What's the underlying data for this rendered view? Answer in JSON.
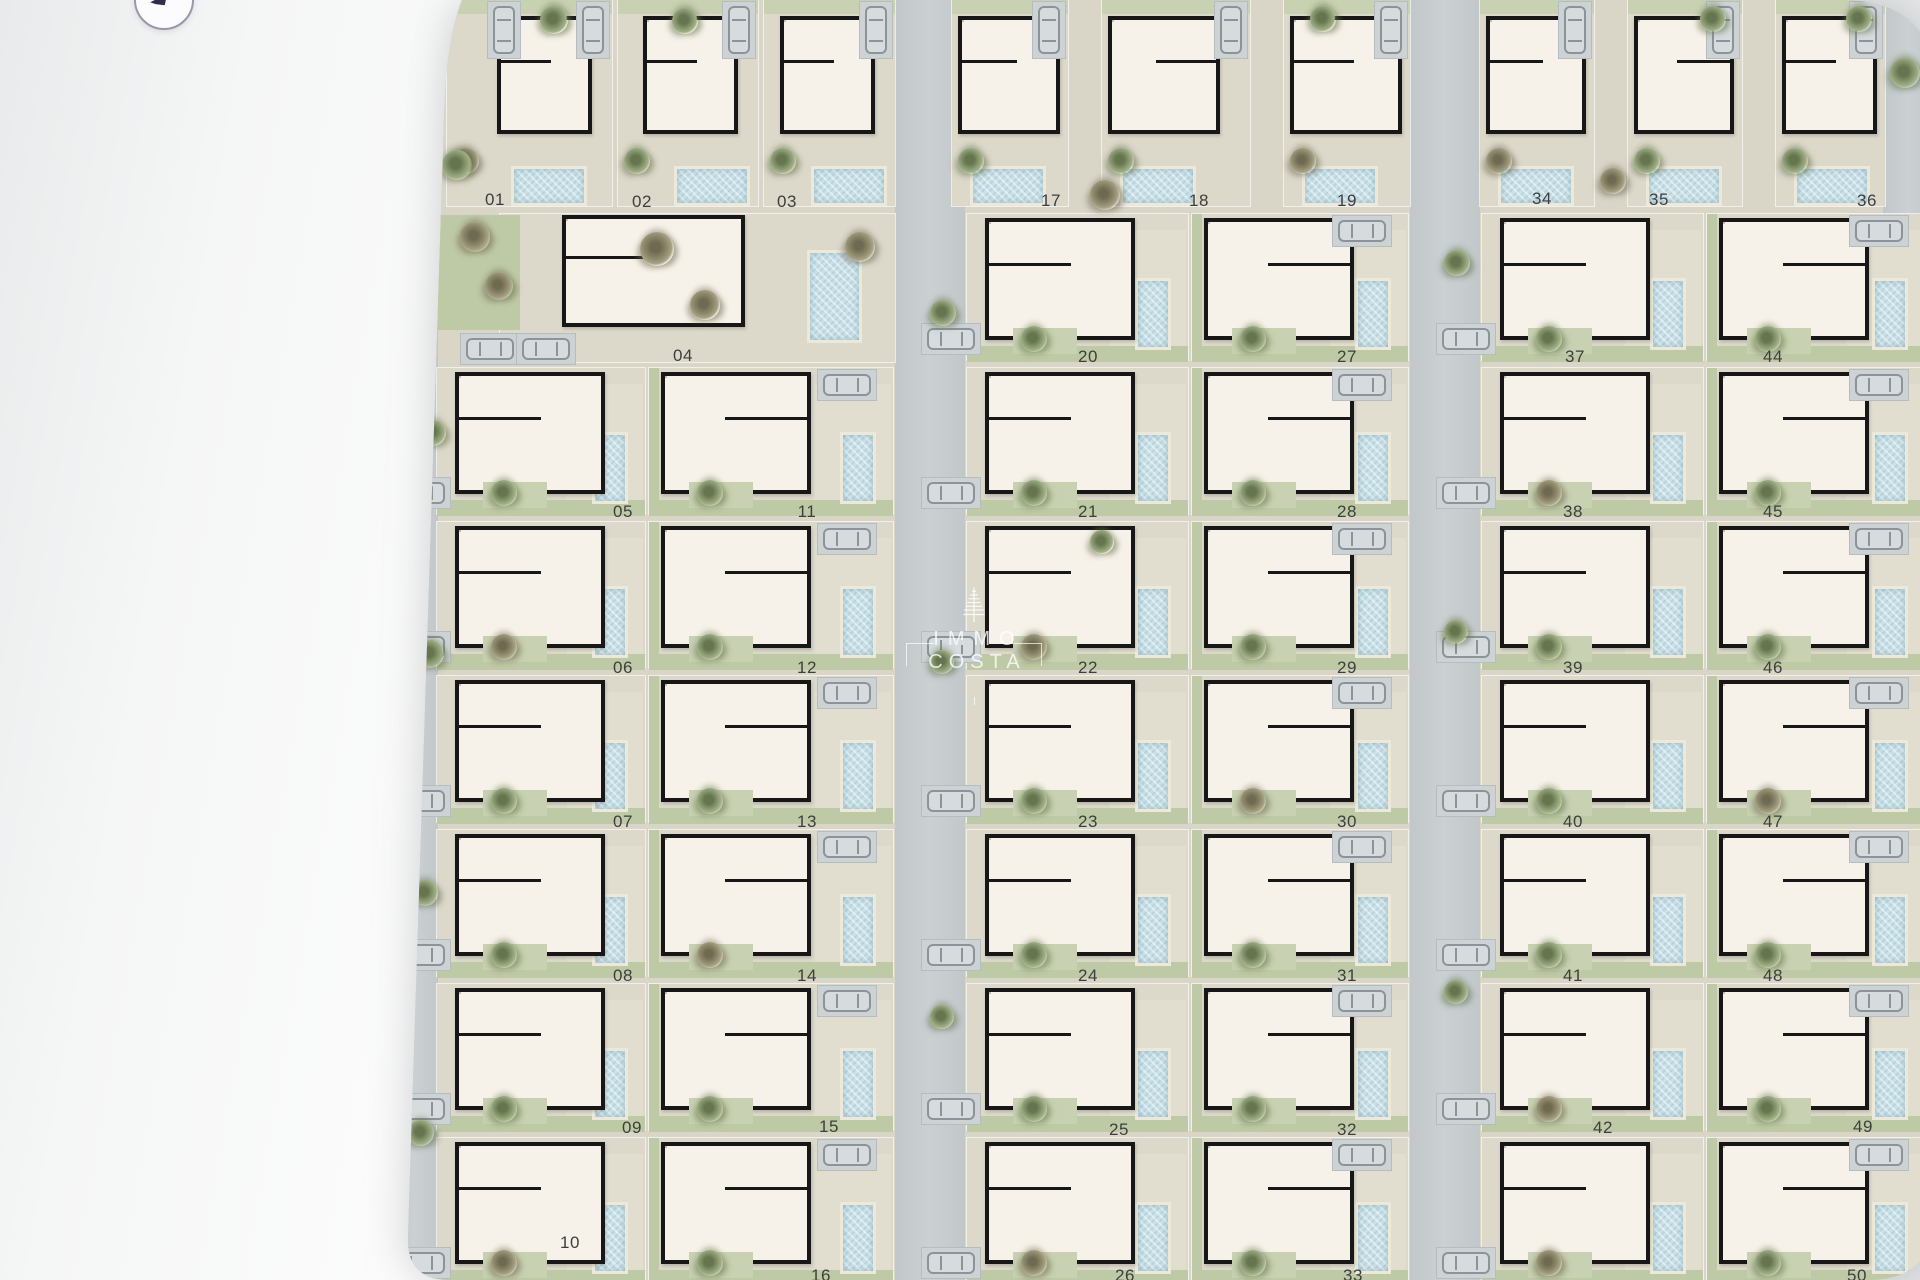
{
  "controls": {
    "back_button_icon": "back-arrow"
  },
  "watermark": {
    "line1": "IMMO",
    "line2": "COSTA",
    "icon": "cypress-tree"
  },
  "site_plan": {
    "type": "residential-site-plan",
    "description_labels_visible": [
      "01",
      "02",
      "03",
      "04",
      "05",
      "06",
      "07",
      "08",
      "09",
      "10",
      "11",
      "12",
      "13",
      "14",
      "15",
      "16",
      "17",
      "18",
      "19",
      "20",
      "21",
      "22",
      "23",
      "24",
      "25",
      "26",
      "27",
      "28",
      "29",
      "30",
      "31",
      "32",
      "33",
      "34",
      "35",
      "36",
      "37",
      "38",
      "39",
      "40",
      "41",
      "42",
      "44",
      "45",
      "46",
      "47",
      "48",
      "49",
      "50"
    ],
    "colors": {
      "road": "#c7cccd",
      "lot_paving": "#dcd8ca",
      "garden": "#bec9a5",
      "house_floor": "#f7f2e9",
      "wall": "#171717",
      "pool_water": "#cbe1e7",
      "pool_deck": "#ece8da",
      "label": "#3e3e3e",
      "page_background": "#ededee",
      "watermark": "#ffffff"
    },
    "plots": [
      {
        "number": "01",
        "block": 0,
        "row": "T",
        "col": 0,
        "label_x": 300,
        "label_y": 200
      },
      {
        "number": "02",
        "block": 0,
        "row": "T",
        "col": 1,
        "label_x": 447,
        "label_y": 202
      },
      {
        "number": "03",
        "block": 0,
        "row": "T",
        "col": 2,
        "label_x": 592,
        "label_y": 202
      },
      {
        "number": "04",
        "block": 0,
        "row": 0,
        "col": "W",
        "label_x": 488,
        "label_y": 356
      },
      {
        "number": "05",
        "block": 0,
        "row": 1,
        "col": 0,
        "label_x": 428,
        "label_y": 512
      },
      {
        "number": "06",
        "block": 0,
        "row": 2,
        "col": 0,
        "label_x": 428,
        "label_y": 668
      },
      {
        "number": "07",
        "block": 0,
        "row": 3,
        "col": 0,
        "label_x": 428,
        "label_y": 822
      },
      {
        "number": "08",
        "block": 0,
        "row": 4,
        "col": 0,
        "label_x": 428,
        "label_y": 976
      },
      {
        "number": "09",
        "block": 0,
        "row": 5,
        "col": 0,
        "label_x": 437,
        "label_y": 1128
      },
      {
        "number": "10",
        "block": 0,
        "row": 6,
        "col": 0,
        "label_x": 375,
        "label_y": 1243
      },
      {
        "number": "11",
        "block": 0,
        "row": 1,
        "col": 1,
        "label_x": 612,
        "label_y": 512
      },
      {
        "number": "12",
        "block": 0,
        "row": 2,
        "col": 1,
        "label_x": 612,
        "label_y": 668
      },
      {
        "number": "13",
        "block": 0,
        "row": 3,
        "col": 1,
        "label_x": 612,
        "label_y": 822
      },
      {
        "number": "14",
        "block": 0,
        "row": 4,
        "col": 1,
        "label_x": 612,
        "label_y": 976
      },
      {
        "number": "15",
        "block": 0,
        "row": 5,
        "col": 1,
        "label_x": 634,
        "label_y": 1127
      },
      {
        "number": "16",
        "block": 0,
        "row": 6,
        "col": 1,
        "label_x": 626,
        "label_y": 1276,
        "partial": true
      },
      {
        "number": "17",
        "block": 1,
        "row": "T",
        "col": 0,
        "label_x": 856,
        "label_y": 201
      },
      {
        "number": "18",
        "block": 1,
        "row": "T",
        "col": 1,
        "label_x": 1004,
        "label_y": 201
      },
      {
        "number": "19",
        "block": 1,
        "row": "T",
        "col": 2,
        "label_x": 1152,
        "label_y": 201
      },
      {
        "number": "20",
        "block": 1,
        "row": 0,
        "col": 0,
        "label_x": 893,
        "label_y": 357
      },
      {
        "number": "21",
        "block": 1,
        "row": 1,
        "col": 0,
        "label_x": 893,
        "label_y": 512
      },
      {
        "number": "22",
        "block": 1,
        "row": 2,
        "col": 0,
        "label_x": 893,
        "label_y": 668
      },
      {
        "number": "23",
        "block": 1,
        "row": 3,
        "col": 0,
        "label_x": 893,
        "label_y": 822
      },
      {
        "number": "24",
        "block": 1,
        "row": 4,
        "col": 0,
        "label_x": 893,
        "label_y": 976
      },
      {
        "number": "25",
        "block": 1,
        "row": 5,
        "col": 0,
        "label_x": 924,
        "label_y": 1130
      },
      {
        "number": "26",
        "block": 1,
        "row": 6,
        "col": 0,
        "label_x": 930,
        "label_y": 1276,
        "partial": true
      },
      {
        "number": "27",
        "block": 1,
        "row": 0,
        "col": 1,
        "label_x": 1152,
        "label_y": 357
      },
      {
        "number": "28",
        "block": 1,
        "row": 1,
        "col": 1,
        "label_x": 1152,
        "label_y": 512
      },
      {
        "number": "29",
        "block": 1,
        "row": 2,
        "col": 1,
        "label_x": 1152,
        "label_y": 668
      },
      {
        "number": "30",
        "block": 1,
        "row": 3,
        "col": 1,
        "label_x": 1152,
        "label_y": 822
      },
      {
        "number": "31",
        "block": 1,
        "row": 4,
        "col": 1,
        "label_x": 1152,
        "label_y": 976
      },
      {
        "number": "32",
        "block": 1,
        "row": 5,
        "col": 1,
        "label_x": 1152,
        "label_y": 1130
      },
      {
        "number": "33",
        "block": 1,
        "row": 6,
        "col": 1,
        "label_x": 1158,
        "label_y": 1276,
        "partial": true
      },
      {
        "number": "34",
        "block": 2,
        "row": "T",
        "col": 0,
        "label_x": 1347,
        "label_y": 199
      },
      {
        "number": "35",
        "block": 2,
        "row": "T",
        "col": 1,
        "label_x": 1464,
        "label_y": 200
      },
      {
        "number": "36",
        "block": 2,
        "row": "T",
        "col": 2,
        "label_x": 1672,
        "label_y": 201
      },
      {
        "number": "37",
        "block": 2,
        "row": 0,
        "col": 0,
        "label_x": 1380,
        "label_y": 357
      },
      {
        "number": "38",
        "block": 2,
        "row": 1,
        "col": 0,
        "label_x": 1378,
        "label_y": 512
      },
      {
        "number": "39",
        "block": 2,
        "row": 2,
        "col": 0,
        "label_x": 1378,
        "label_y": 668
      },
      {
        "number": "40",
        "block": 2,
        "row": 3,
        "col": 0,
        "label_x": 1378,
        "label_y": 822
      },
      {
        "number": "41",
        "block": 2,
        "row": 4,
        "col": 0,
        "label_x": 1378,
        "label_y": 976
      },
      {
        "number": "42",
        "block": 2,
        "row": 5,
        "col": 0,
        "label_x": 1408,
        "label_y": 1128
      },
      {
        "number": "44",
        "block": 2,
        "row": 0,
        "col": 1,
        "label_x": 1578,
        "label_y": 357
      },
      {
        "number": "45",
        "block": 2,
        "row": 1,
        "col": 1,
        "label_x": 1578,
        "label_y": 512
      },
      {
        "number": "46",
        "block": 2,
        "row": 2,
        "col": 1,
        "label_x": 1578,
        "label_y": 668
      },
      {
        "number": "47",
        "block": 2,
        "row": 3,
        "col": 1,
        "label_x": 1578,
        "label_y": 822
      },
      {
        "number": "48",
        "block": 2,
        "row": 4,
        "col": 1,
        "label_x": 1578,
        "label_y": 976
      },
      {
        "number": "49",
        "block": 2,
        "row": 5,
        "col": 1,
        "label_x": 1668,
        "label_y": 1127
      },
      {
        "number": "50",
        "block": 2,
        "row": 6,
        "col": 1,
        "label_x": 1662,
        "label_y": 1276,
        "partial": true
      }
    ],
    "unlabeled_plots": [
      {
        "block": 2,
        "row": 6,
        "col": 0
      }
    ]
  }
}
